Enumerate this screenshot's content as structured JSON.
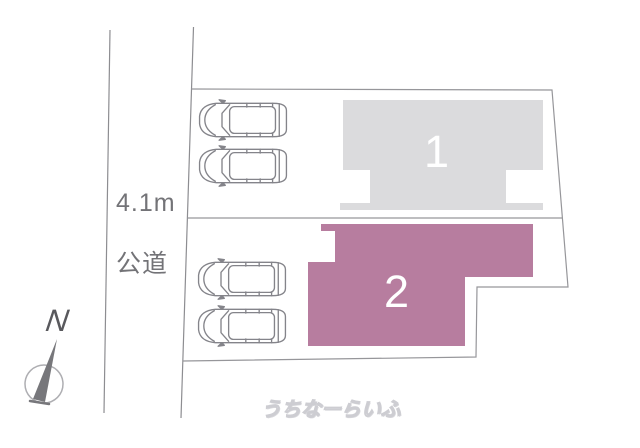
{
  "canvas": {
    "width": 640,
    "height": 448
  },
  "colors": {
    "lot1_fill": "#dbdbdd",
    "lot2_fill": "#b77d9f",
    "boundary_line": "#96969a",
    "road_line": "#8d8d91",
    "car_stroke": "#84848a",
    "compass_needle": "#77777b",
    "compass_circle": "#aeaeb2"
  },
  "road": {
    "width_label": "4.1m",
    "type_label": "公道"
  },
  "compass": {
    "north_label": "N"
  },
  "lots": {
    "lot1_number": "1",
    "lot2_number": "2"
  },
  "parking": {
    "car_count": 4
  },
  "watermark": {
    "brand": "うちなーらいふ"
  }
}
